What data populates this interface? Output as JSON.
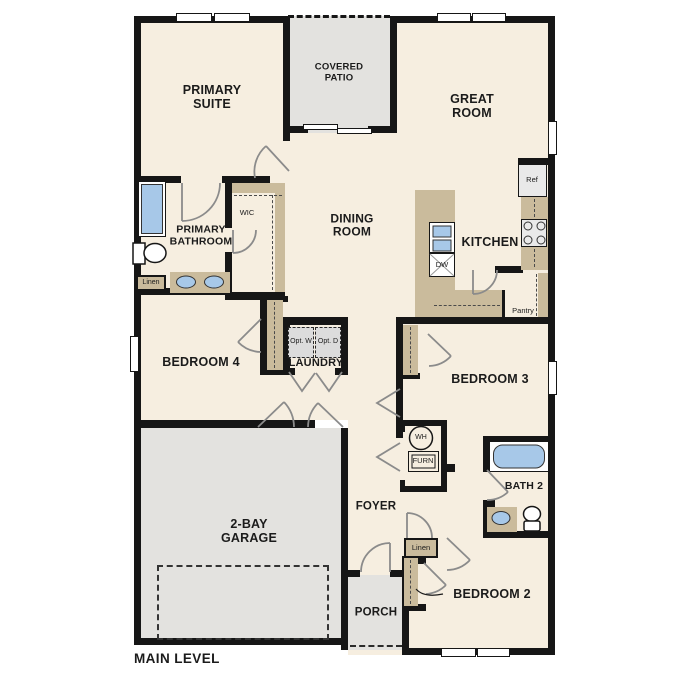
{
  "plan_title": "MAIN LEVEL",
  "rooms": {
    "primary_suite": "PRIMARY SUITE",
    "covered_patio": "COVERED PATIO",
    "great_room": "GREAT ROOM",
    "dining_room": "DINING ROOM",
    "kitchen": "KITCHEN",
    "primary_bathroom": "PRIMARY BATHROOM",
    "wic": "WIC",
    "bedroom_4": "BEDROOM 4",
    "laundry": "LAUNDRY",
    "bedroom_3": "BEDROOM 3",
    "pantry": "Pantry",
    "garage": "2-BAY GARAGE",
    "foyer": "FOYER",
    "bath_2": "BATH 2",
    "porch": "PORCH",
    "bedroom_2": "BEDROOM 2"
  },
  "fixtures": {
    "refrigerator": "Ref",
    "dishwasher": "DW",
    "optional_washer": "Opt. W",
    "optional_dryer": "Opt. D",
    "water_heater": "WH",
    "furnace": "FURN",
    "linen_bathroom": "Linen",
    "linen_hall": "Linen"
  },
  "colors": {
    "wall": "#161616",
    "interior_floor": "#f6eee0",
    "outdoor_floor": "#e3e2df",
    "cabinet_tan": "#cabb9c",
    "plumbing_blue": "#a7c8e8",
    "appliance_gray": "#e9e9e9",
    "optional_gray": "#dcdcdc",
    "door_swing_gray": "#8b8b8b"
  }
}
